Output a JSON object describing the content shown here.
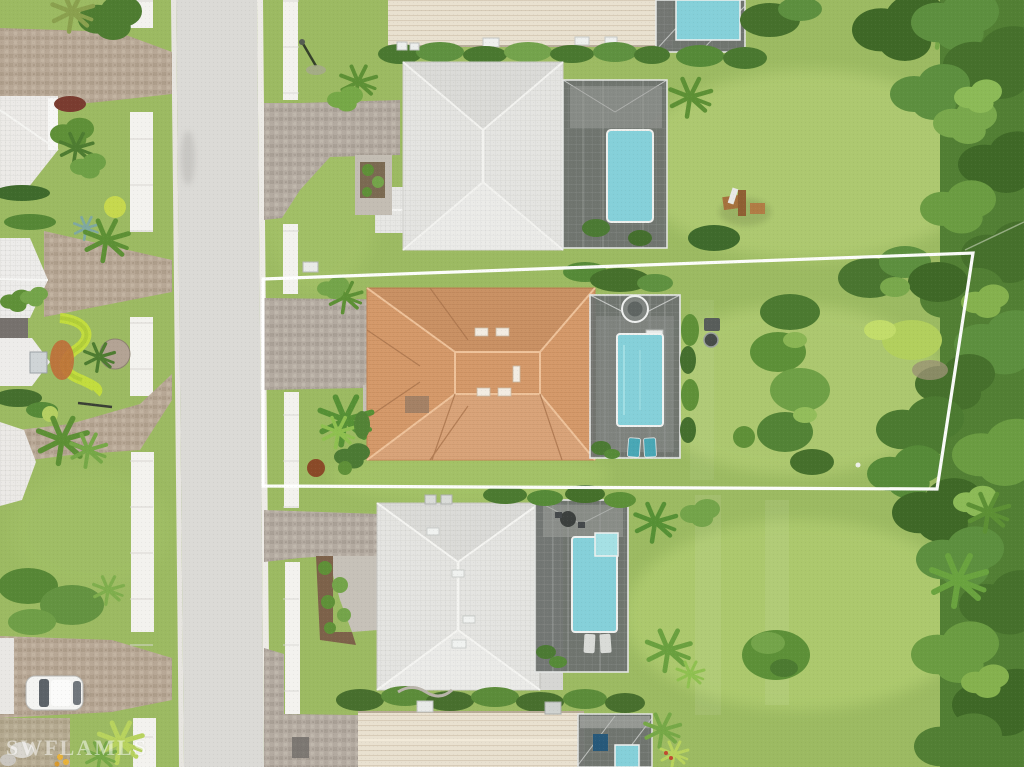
{
  "image_type": "aerial-drone-photograph",
  "description": "Overhead aerial view of a residential street; subject lot outlined in white contains a house with an orange terracotta tile roof, paver driveway, screened pool enclosure with pool and round spa, and a deep rear lawn bordered by trees.",
  "watermark": {
    "text": "SWFLAMLS",
    "color": "#ffffff",
    "opacity": 0.5
  },
  "boundary": {
    "label": "property-lot-outline",
    "color": "#ffffff",
    "points": "263,279 973,253 937,489 263,486"
  },
  "palette": {
    "grass": "#9cba62",
    "grass_light": "#b8d178",
    "street": "#dbdad6",
    "curb": "#edebe6",
    "sidewalk": "#f3f2ee",
    "pavers_left": "#b7a795",
    "pavers_right": "#b3aaa0",
    "roof_subject": "#d59a6b",
    "roof_subject_ridge": "#eec29a",
    "roof_gray": "#e4e4e1",
    "roof_beige": "#e9e1d0",
    "pool_water": "#85d0d9",
    "enclosure_screen": "#6e736f",
    "enclosure_frame": "#e6e8e6",
    "hedge_lime": "#c2dc3e",
    "mulch": "#7d624a",
    "tree_dark": "#3f6827",
    "tree_mid": "#527f34",
    "tree_light": "#79a84c",
    "car": "#f4f4f2"
  },
  "scene": {
    "street": {
      "orientation": "vertical",
      "type": "residential two-way",
      "position": "left-center"
    },
    "sidewalks": {
      "count": 2,
      "color_name": "white concrete",
      "crossed_by": "paver driveways"
    },
    "houses": [
      {
        "id": "top-partial",
        "roof": "beige ridged tile",
        "pool": true,
        "position": "top-center, cut by frame"
      },
      {
        "id": "north-neighbor",
        "roof": "light gray tile hip",
        "pool": true,
        "screened_enclosure": true,
        "backyard": "lawn with wooden play set",
        "position": "upper-center"
      },
      {
        "id": "subject",
        "outlined": true,
        "roof": "orange terracotta tile hip",
        "pool": true,
        "spa": "round",
        "screened_enclosure": true,
        "driveway": "brick pavers",
        "rear": "deep lawn with hedge row and tree line",
        "position": "center"
      },
      {
        "id": "south-neighbor",
        "roof": "light gray tile hip",
        "pool": true,
        "spa": "square",
        "screened_enclosure": true,
        "front_bed": "mulch with shrubs",
        "position": "lower-center"
      },
      {
        "id": "bottom-partial",
        "roof": "beige ridged tile",
        "pool": true,
        "screened_enclosure": true,
        "position": "bottom-center, cut by frame"
      },
      {
        "id": "west-row-homes",
        "roof": "white tile gables",
        "count": 4,
        "position": "left edge, partially visible"
      }
    ],
    "vehicles": [
      {
        "type": "car",
        "color": "white",
        "location": "driveway lower-left"
      }
    ],
    "vegetation": [
      "palms",
      "clipped hedges",
      "lime-green curved hedge",
      "dense tree line on right edge",
      "shrub beds"
    ],
    "other": [
      "lamp post with shadow upper-right of street",
      "wooden play set in upper lawn",
      "grill behind subject enclosure",
      "white sprinkler dot in rear lawn"
    ]
  }
}
